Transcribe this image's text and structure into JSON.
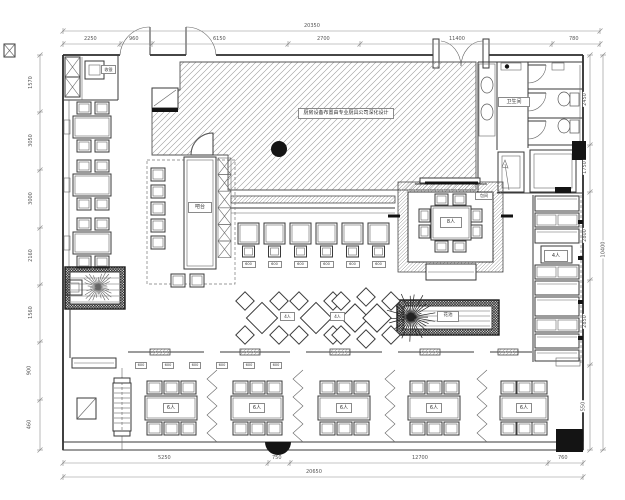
{
  "drawing": {
    "type": "restaurant-floor-plan",
    "labels": {
      "kitchen_note": "厨房设备布置由专业厨具公司深化设计",
      "bar": "吧台",
      "wc": "卫生间",
      "cashier": "收银",
      "private_room": "包间",
      "private_table": "8人",
      "booth_table": "4人",
      "diamond_table": "4人",
      "bottom_table": "6人",
      "planter": "花池",
      "seat_tag": "600"
    },
    "dimensions": {
      "top": {
        "total": "20350",
        "segments": [
          "2250",
          "960",
          "6150",
          "2700",
          "11400",
          "780"
        ]
      },
      "bottom": {
        "total": "20650",
        "segments": [
          "5250",
          "750",
          "12700",
          "760"
        ]
      },
      "left": {
        "segments": [
          "1570",
          "3050",
          "3000",
          "2160",
          "1560",
          "900",
          "460"
        ]
      },
      "right": {
        "total": "10400",
        "segments": [
          "2450",
          "1750",
          "2800",
          "2850",
          "550"
        ]
      }
    }
  }
}
